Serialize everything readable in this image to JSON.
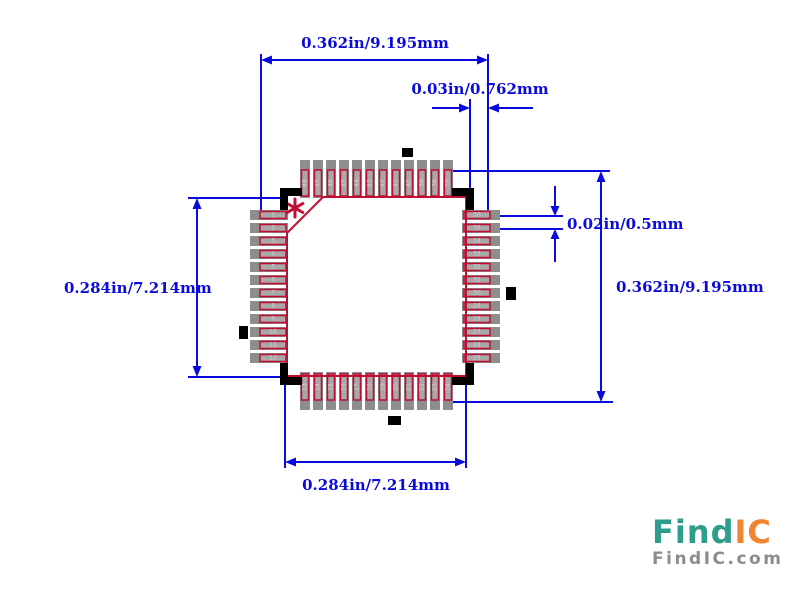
{
  "diagram": {
    "type": "ic-footprint-land-pattern",
    "package_style": "QFP",
    "pins_per_side": 12,
    "total_pins": 48,
    "pin1_marker": "*"
  },
  "footprint": {
    "pin_numbers": {
      "left_top_to_bottom": [
        1,
        2,
        3,
        4,
        5,
        6,
        7,
        8,
        9,
        10,
        11,
        12
      ],
      "bottom_left_to_right": [
        13,
        14,
        15,
        16,
        17,
        18,
        19,
        20,
        21,
        22,
        23,
        24
      ],
      "right_top_to_bottom": [
        36,
        35,
        34,
        33,
        32,
        31,
        30,
        29,
        28,
        27,
        26,
        25
      ],
      "top_left_to_right": [
        48,
        47,
        46,
        45,
        44,
        43,
        42,
        41,
        40,
        39,
        38,
        37
      ]
    }
  },
  "dimensions": {
    "top_lead_span": "0.362in/9.195mm",
    "pad_length": "0.03in/0.762mm",
    "pad_pitch": "0.02in/0.5mm",
    "right_lead_span": "0.362in/9.195mm",
    "left_body_height": "0.284in/7.214mm",
    "bottom_body_width": "0.284in/7.214mm"
  },
  "colors": {
    "background": "#ffffff",
    "dimension_blue": "#0a0adc",
    "outline_crimson": "#c00d32",
    "pad_gray": "#8d8d8d",
    "pad_inner_gray": "#a8a8a8",
    "pin_number_gray": "#cfcfcf",
    "silkscreen_black": "#000000",
    "logo_teal": "#2e9d8c",
    "logo_orange": "#ef8432",
    "logo_gray": "#8c8c8c"
  },
  "logo": {
    "brand_find": "Find",
    "brand_ic": "IC",
    "domain": "FindIC.com"
  }
}
